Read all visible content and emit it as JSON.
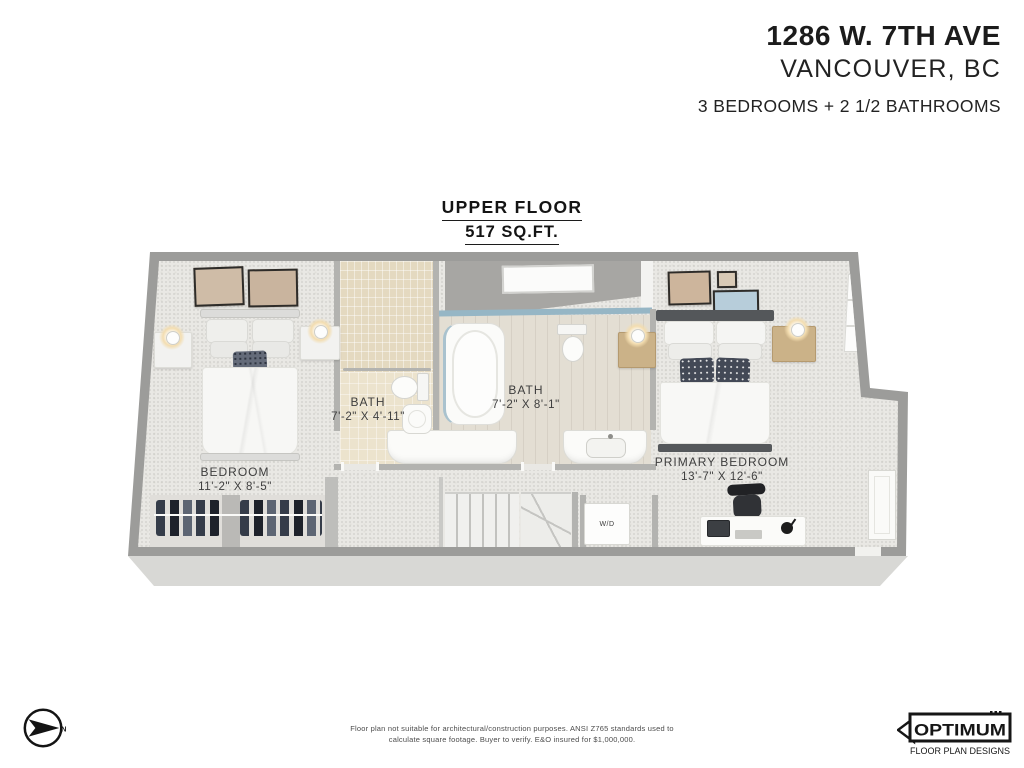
{
  "header": {
    "address": "1286 W. 7TH AVE",
    "city": "VANCOUVER, BC",
    "summary": "3 BEDROOMS + 2 1/2 BATHROOMS"
  },
  "floor": {
    "title": "UPPER FLOOR",
    "area": "517 SQ.FT."
  },
  "rooms": {
    "bedroom": {
      "label": "BEDROOM",
      "dims": "11'-2\" X 8'-5\""
    },
    "bath_small": {
      "label": "BATH",
      "dims": "7'-2\" X 4'-11\""
    },
    "bath_main": {
      "label": "BATH",
      "dims": "7'-2\" X 8'-1\""
    },
    "primary": {
      "label": "PRIMARY BEDROOM",
      "dims": "13'-7\" X 12'-6\""
    },
    "laundry": {
      "label": "W/D"
    }
  },
  "compass": {
    "north": "N"
  },
  "footer": {
    "disclaimer1": "Floor plan not suitable for architectural/construction purposes. ANSI Z765 standards used to",
    "disclaimer2": "calculate square footage. Buyer to verify.  E&O insured for $1,000,000.",
    "logo": {
      "name": "OPTIMUM",
      "tagline": "FLOOR PLAN DESIGNS"
    }
  },
  "colors": {
    "wall": "#9c9c9a",
    "carpet": "#e9e8e4",
    "tile_beige": "#e4d9c0",
    "glass_accent": "#96b6c5",
    "text_dark": "#1b1b1b",
    "label_gray": "#3e3e3e"
  }
}
